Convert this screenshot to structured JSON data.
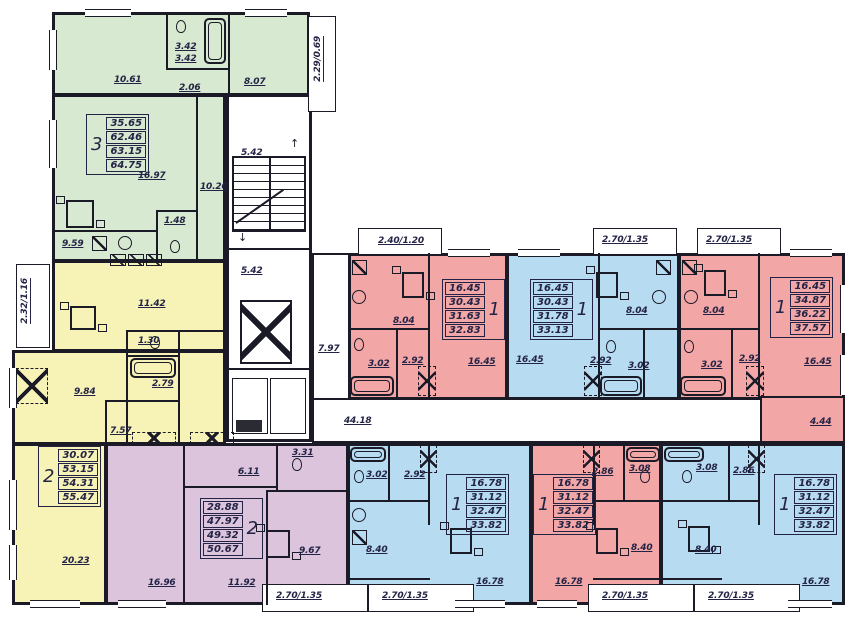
{
  "colors": {
    "green": "#d7e9d0",
    "yellow": "#f7f2b6",
    "purple": "#dbc4dc",
    "pink": "#f2a6a6",
    "blue": "#b7dbf0",
    "wall": "#1b1b28",
    "text": "#232345"
  },
  "icons": {
    "arrow_up": "↑",
    "arrow_down": "↓",
    "elevator": "x-box",
    "balcony_door": "x-box-dashed",
    "stairs": "hatched-treads"
  },
  "core": {
    "stairs": "5.42",
    "hall": "5.42",
    "corridor_vertical": "7.97",
    "corridor_main": "44.18"
  },
  "dims": {
    "left_balcony": "2.32/1.16",
    "green_balcony": "2.29/0.69",
    "top": [
      "2.40/1.20",
      "2.70/1.35",
      "2.70/1.35"
    ],
    "bottom": [
      "2.70/1.35",
      "2.70/1.35",
      "2.70/1.35",
      "2.70/1.35"
    ]
  },
  "apartments": {
    "apt3_green": {
      "type": "3",
      "areas": [
        "35.65",
        "62.46",
        "63.15",
        "64.75"
      ],
      "rooms": {
        "bedroom1": "10.61",
        "bath_a": "3.42",
        "bath_b": "3.42",
        "hall": "2.06",
        "bedroom2": "8.07",
        "living": "16.97",
        "corridor": "10.26",
        "kitchen": "9.59",
        "wc": "1.48"
      }
    },
    "apt2_yellow": {
      "type": "2",
      "areas": [
        "30.07",
        "53.15",
        "54.31",
        "55.47"
      ],
      "rooms": {
        "kitchen": "11.42",
        "wc": "1.30",
        "bath": "2.79",
        "bedroom": "9.84",
        "hall": "7.57",
        "living": "20.23"
      }
    },
    "apt2_purple": {
      "type": "2",
      "areas": [
        "28.88",
        "47.97",
        "49.32",
        "50.67"
      ],
      "rooms": {
        "hall": "6.11",
        "wc": "3.31",
        "kitchen": "9.67",
        "bedroom": "16.96",
        "living": "11.92"
      }
    },
    "apt1_pink_top": {
      "type": "1",
      "areas": [
        "16.45",
        "30.43",
        "31.63",
        "32.83"
      ],
      "rooms": {
        "kitchen": "8.04",
        "bath": "3.02",
        "hall": "2.92",
        "living": "16.45"
      }
    },
    "apt1_blue_top": {
      "type": "1",
      "areas": [
        "16.45",
        "30.43",
        "31.78",
        "33.13"
      ],
      "rooms": {
        "kitchen": "8.04",
        "bath": "3.02",
        "hall": "2.92",
        "living": "16.45"
      }
    },
    "apt1_pink_right": {
      "type": "1",
      "areas": [
        "16.45",
        "34.87",
        "36.22",
        "37.57"
      ],
      "rooms": {
        "kitchen": "8.04",
        "bath": "3.02",
        "hall": "2.92",
        "living": "16.45",
        "corridor": "4.44"
      }
    },
    "apt1_blue_bottom1": {
      "type": "1",
      "areas": [
        "16.78",
        "31.12",
        "32.47",
        "33.82"
      ],
      "rooms": {
        "bath": "3.02",
        "hall": "2.92",
        "kitchen": "8.40",
        "living": "16.78"
      }
    },
    "apt1_pink_bottom": {
      "type": "1",
      "areas": [
        "16.78",
        "31.12",
        "32.47",
        "33.82"
      ],
      "rooms": {
        "hall": "2.86",
        "bath": "3.08",
        "kitchen": "8.40",
        "living": "16.78"
      }
    },
    "apt1_blue_bottom2": {
      "type": "1",
      "areas": [
        "16.78",
        "31.12",
        "32.47",
        "33.82"
      ],
      "rooms": {
        "bath": "3.08",
        "hall": "2.86",
        "kitchen": "8.40",
        "living": "16.78"
      }
    }
  }
}
